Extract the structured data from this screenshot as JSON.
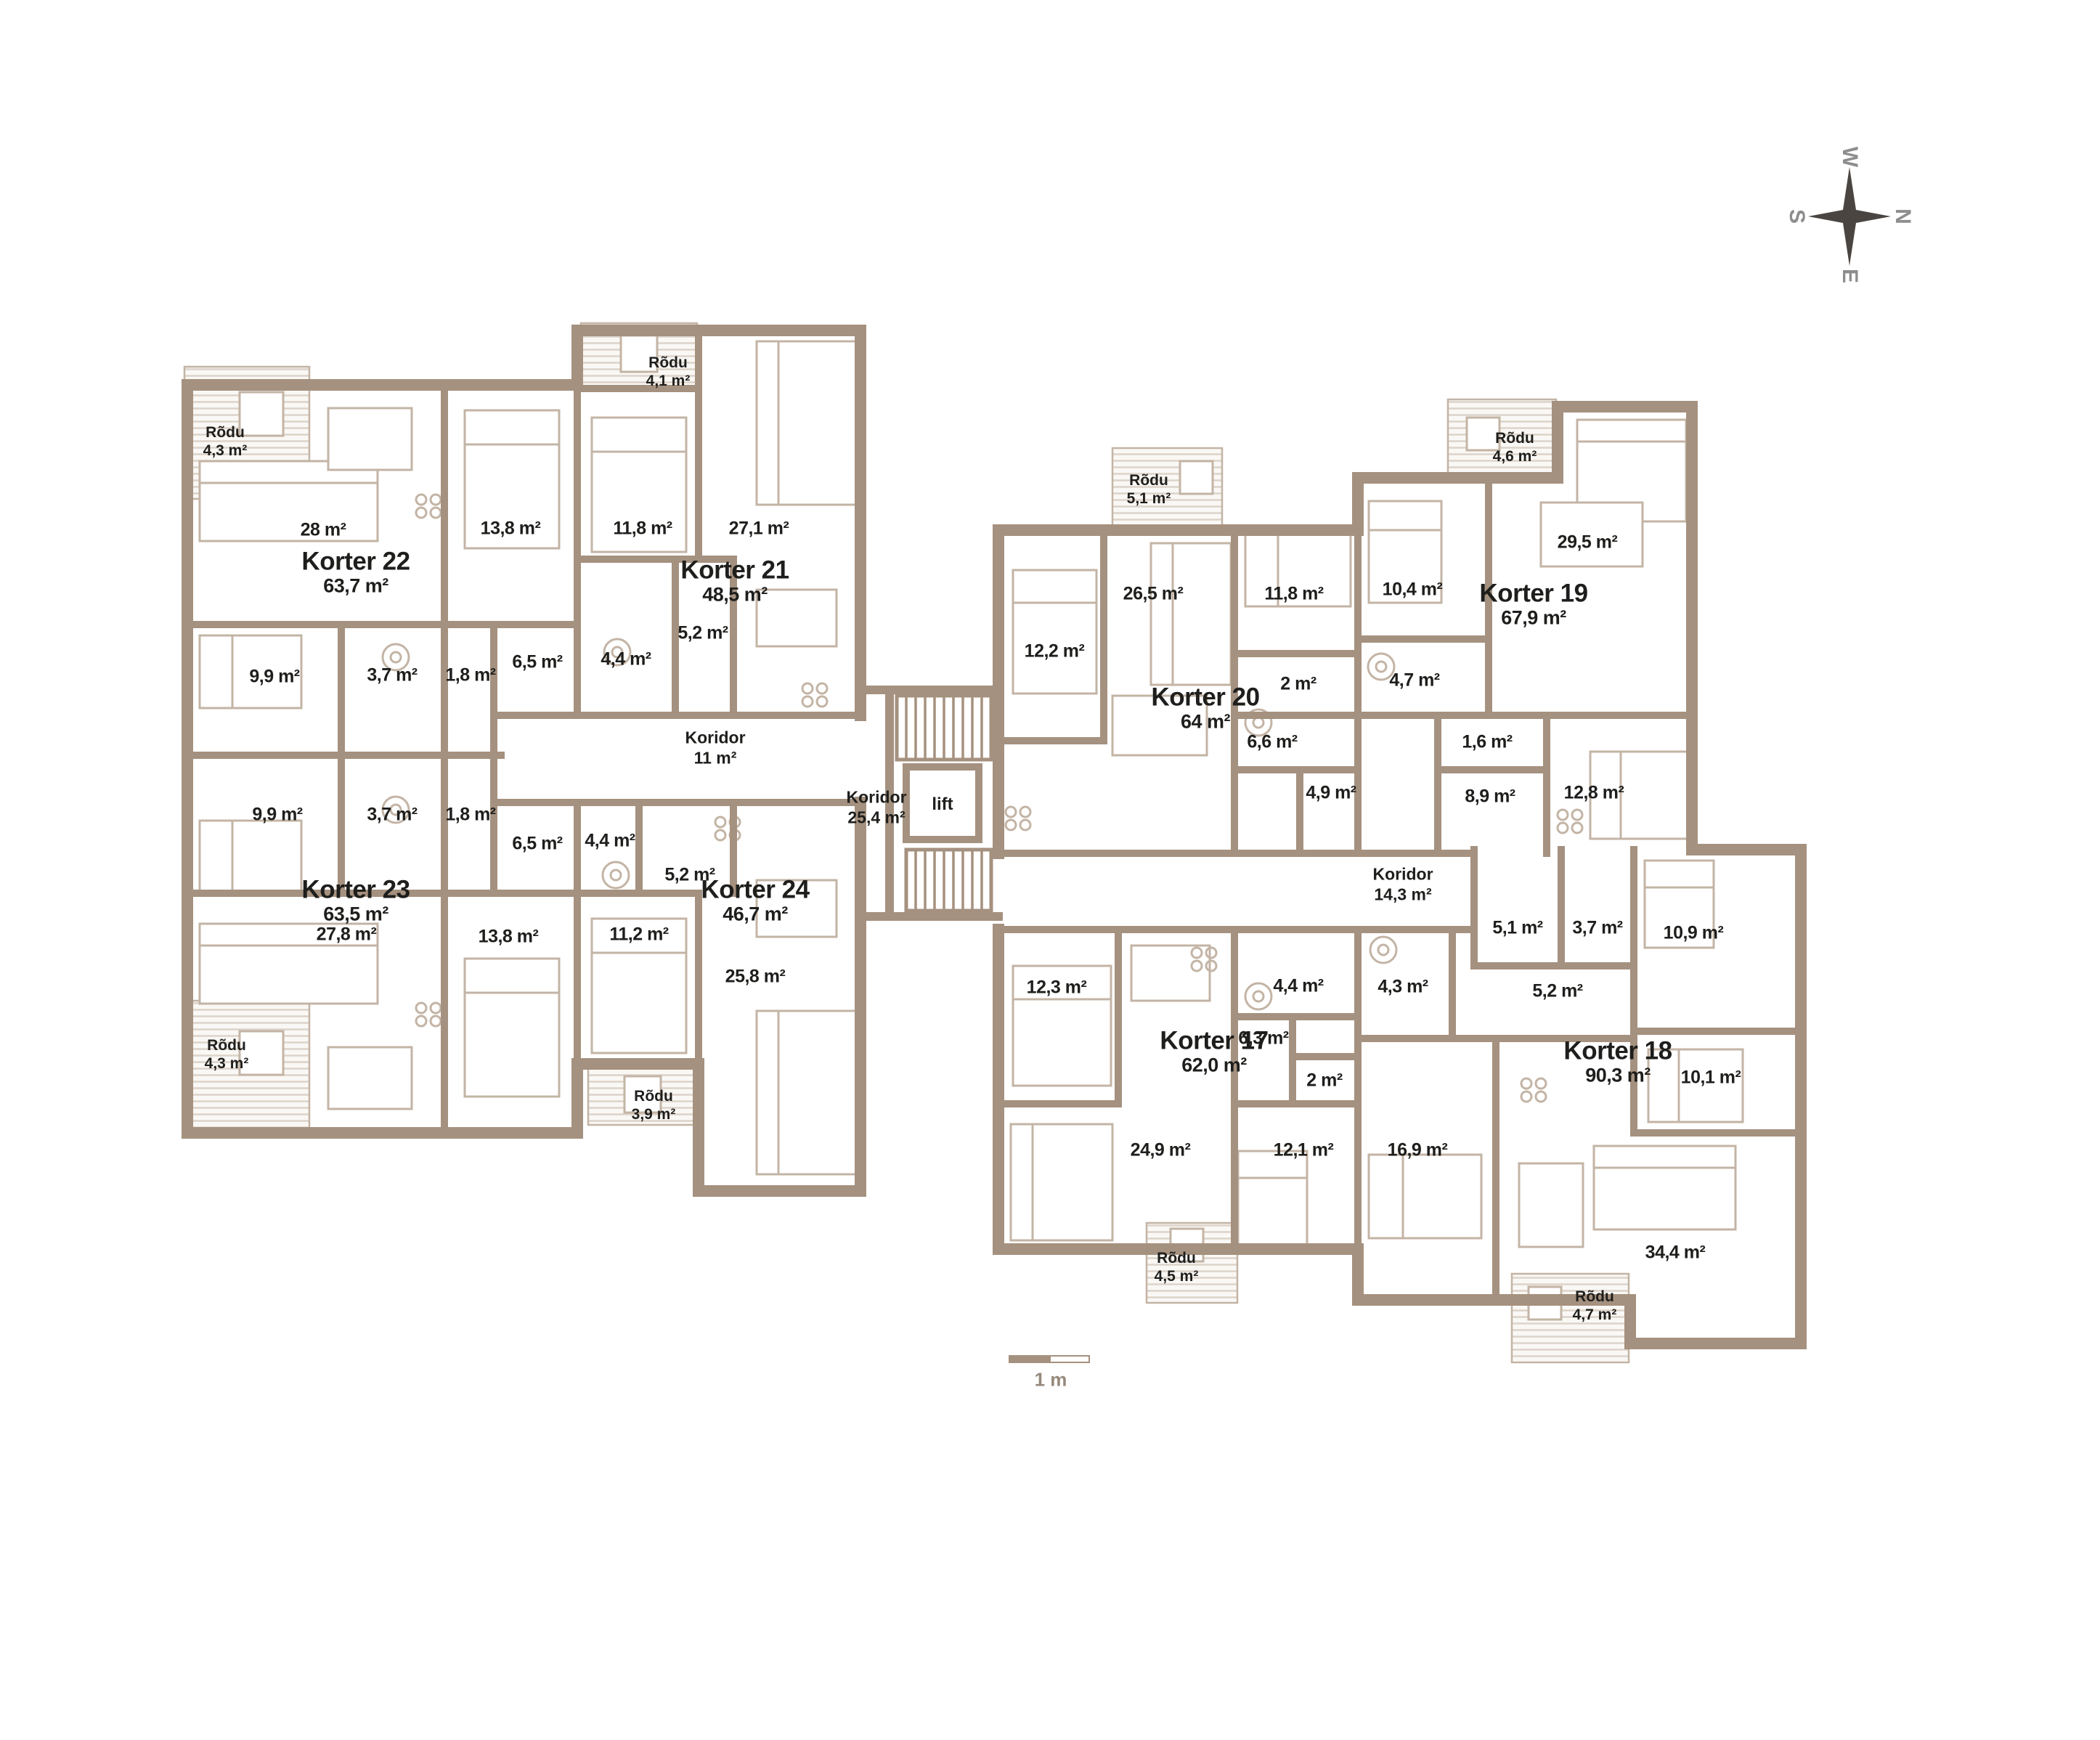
{
  "compass": {
    "n": "N",
    "e": "E",
    "s": "S",
    "w": "W"
  },
  "scale": {
    "label": "1 m"
  },
  "core": {
    "lift": "lift"
  },
  "corridors": {
    "c11": {
      "name": "Koridor",
      "area": "11 m²"
    },
    "c25": {
      "name": "Koridor",
      "area": "25,4 m²"
    },
    "c14": {
      "name": "Koridor",
      "area": "14,3 m²"
    }
  },
  "apartments": {
    "k17": {
      "name": "Korter 17",
      "area": "62,0 m²",
      "balcony": {
        "name": "Rõdu",
        "area": "4,5 m²"
      },
      "rooms": {
        "living": "24,9 m²",
        "bedroom1": "12,3 m²",
        "bedroom2": "12,1 m²",
        "hall": "6,3 m²",
        "wc": "2 m²",
        "bath": "4,4 m²"
      }
    },
    "k18": {
      "name": "Korter 18",
      "area": "90,3 m²",
      "balcony": {
        "name": "Rõdu",
        "area": "4,7 m²"
      },
      "rooms": {
        "living": "34,4 m²",
        "bedroom1": "16,9 m²",
        "bedroom2": "10,9 m²",
        "bedroom3": "10,1 m²",
        "bath": "4,3 m²",
        "hall1": "5,1 m²",
        "hall2": "3,7 m²",
        "hall3": "5,2 m²"
      }
    },
    "k19": {
      "name": "Korter 19",
      "area": "67,9 m²",
      "balcony": {
        "name": "Rõdu",
        "area": "4,6 m²"
      },
      "rooms": {
        "living": "29,5 m²",
        "bedroom1": "10,4 m²",
        "bedroom2": "12,8 m²",
        "bath": "4,7 m²",
        "wc": "1,6 m²",
        "hall": "8,9 m²"
      }
    },
    "k20": {
      "name": "Korter 20",
      "area": "64 m²",
      "balcony": {
        "name": "Rõdu",
        "area": "5,1 m²"
      },
      "rooms": {
        "living": "26,5 m²",
        "bedroom1": "12,2 m²",
        "bedroom2": "11,8 m²",
        "wc": "2 m²",
        "hall": "6,6 m²",
        "bath": "4,9 m²"
      }
    },
    "k21": {
      "name": "Korter 21",
      "area": "48,5 m²",
      "balcony": {
        "name": "Rõdu",
        "area": "4,1 m²"
      },
      "rooms": {
        "living": "27,1 m²",
        "bedroom": "11,8 m²",
        "hall": "5,2 m²",
        "bath": "4,4 m²"
      }
    },
    "k22": {
      "name": "Korter 22",
      "area": "63,7 m²",
      "balcony": {
        "name": "Rõdu",
        "area": "4,3 m²"
      },
      "rooms": {
        "living": "28 m²",
        "bedroom1": "13,8 m²",
        "bedroom2": "9,9 m²",
        "closet": "3,7 m²",
        "wc": "1,8 m²",
        "hall": "6,5 m²"
      }
    },
    "k23": {
      "name": "Korter 23",
      "area": "63,5 m²",
      "balcony": {
        "name": "Rõdu",
        "area": "4,3 m²"
      },
      "rooms": {
        "living": "27,8 m²",
        "bedroom1": "13,8 m²",
        "bedroom2": "9,9 m²",
        "closet": "3,7 m²",
        "wc": "1,8 m²",
        "hall": "6,5 m²"
      }
    },
    "k24": {
      "name": "Korter 24",
      "area": "46,7 m²",
      "balcony": {
        "name": "Rõdu",
        "area": "3,9 m²"
      },
      "rooms": {
        "living": "25,8 m²",
        "bedroom": "11,2 m²",
        "hall": "5,2 m²",
        "bath": "4,4 m²"
      }
    }
  },
  "colors": {
    "wall": "#a5917f",
    "furniture": "#c3b4a5",
    "deck_hatch": "#dcd3c9",
    "text": "#1e1e1c",
    "compass_star": "#4a4541",
    "compass_letters": "#8d8d8d"
  }
}
